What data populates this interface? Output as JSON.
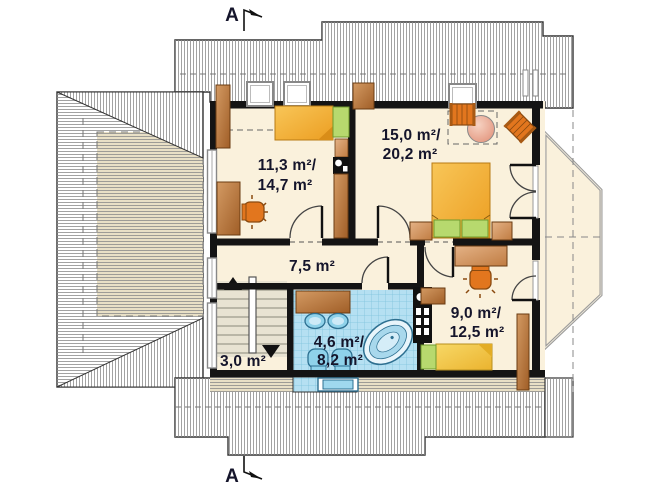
{
  "plan": {
    "title": "attic-floor-plan",
    "section_markers": {
      "top": "A",
      "bottom": "A"
    },
    "rooms": [
      {
        "name": "bedroom-top-left",
        "line1": "11,3 m²/",
        "line2": "14,7 m²"
      },
      {
        "name": "bedroom-top-right",
        "line1": "15,0 m²/",
        "line2": "20,2 m²"
      },
      {
        "name": "hallway",
        "line1": "7,5 m²",
        "line2": ""
      },
      {
        "name": "staircase",
        "line1": "3,0 m²",
        "line2": ""
      },
      {
        "name": "bathroom",
        "line1": "4,6 m²/",
        "line2": "8,2 m²"
      },
      {
        "name": "bedroom-bottom-right",
        "line1": "9,0 m²/",
        "line2": "12,5 m²"
      }
    ],
    "colors": {
      "wall": "#141414",
      "floor": "#FAF1DC",
      "roof_hatch_line": "#8a8a8a",
      "roof_beige": "#E9E0C6",
      "tile_blue": "#B5E0F2",
      "tile_grid": "#7FC3DC",
      "furniture_wood": "#BA7A3E",
      "furniture_wood_light": "#D9A272",
      "bed_orange": "#F3AE3C",
      "bed_yellow": "#F2C94E",
      "pillow_green": "#B7D96E",
      "chair_orange": "#E2761E",
      "table_pink": "#EFB49E",
      "fixture_blue": "#8FD2EA",
      "text": "#15152B"
    }
  }
}
